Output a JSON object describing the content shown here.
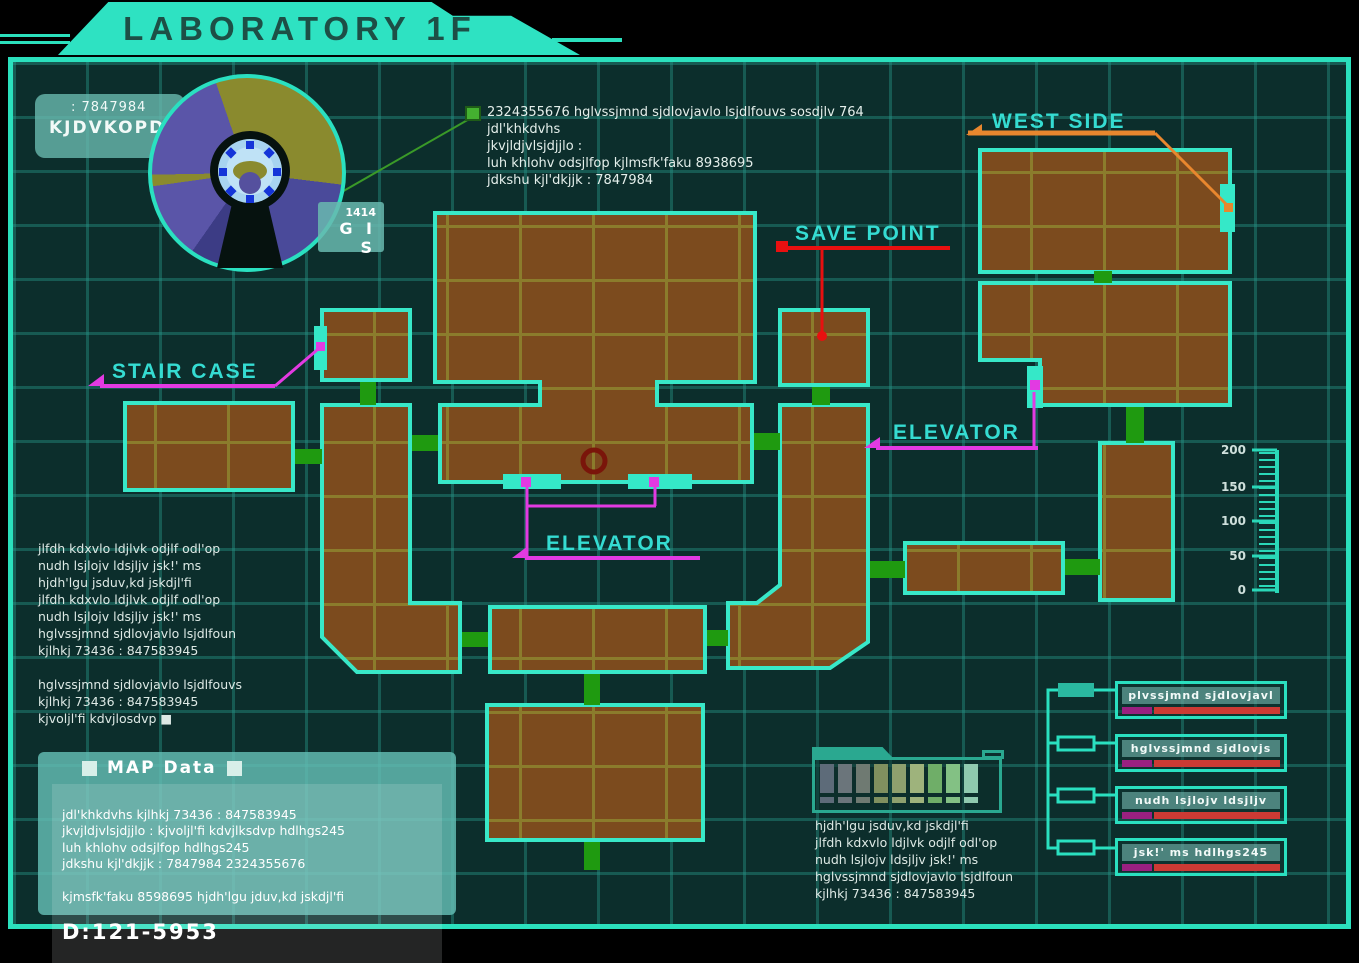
{
  "title": "LABORATORY 1F",
  "radar": {
    "code": ": 7847984",
    "name": "KJDVKOPDS",
    "badge_value": "1414",
    "badge_label": "G I S"
  },
  "k_block": {
    "heading": "K:2501-GIS",
    "lines": [
      "hjdh'lgu jduv,kd jskdjlfi",
      "jlfdh kdxvlo ldjlvk odjlf odl'op",
      "nudh lsjlolv ldsjllv 2sk!' ms",
      "",
      "makluku ims"
    ]
  },
  "annotation": {
    "lines": [
      "2324355676 hglvssjmnd sjdlovjavlo lsjdlfouvs sosdjlv 764",
      "jdl'khkdvhs",
      "jkvjldjvlsjdjjlo :",
      "luh khlohv odsjlfop kjlmsfk'faku 8938695",
      "jdkshu kjl'dkjjk : 7847984"
    ]
  },
  "map_labels": {
    "west_side": "WEST SIDE",
    "save_point": "SAVE POINT",
    "stair_case": "STAIR CASE",
    "elevator_center": "ELEVATOR",
    "elevator_east": "ELEVATOR"
  },
  "left_block": {
    "lines": [
      "jlfdh kdxvlo ldjlvk odjlf odl'op",
      "nudh lsjlojv ldsjljv jsk!' ms",
      "hjdh'lgu jsduv,kd jskdjl'fi",
      "jlfdh kdxvlo ldjlvk odjlf odl'op",
      "nudh lsjlojv ldsjljv jsk!' ms",
      "hglvssjmnd sjdlovjavlo lsjdlfoun",
      "kjlhkj 73436 : 847583945",
      "",
      "hglvssjmnd sjdlovjavlo lsjdlfouvs",
      "kjlhkj 73436 : 847583945",
      "kjvoljl'fi kdvjlosdvp ■"
    ]
  },
  "map_data_panel": {
    "heading": "MAP Data",
    "lines": [
      "jdl'khkdvhs kjlhkj 73436 : 847583945",
      "jkvjldjvlsjdjjlo :  kjvoljl'fi kdvjlksdvp hdlhgs245",
      "luh khlohv odsjlfop hdlhgs245",
      "jdkshu kjl'dkjjk : 7847984 2324355676",
      "",
      "kjmsfk'faku 8598695 hjdh'lgu jduv,kd jskdjl'fi"
    ],
    "id": "D:121-5953"
  },
  "scale": {
    "ticks": [
      "200",
      "150",
      "100",
      "50",
      "0"
    ]
  },
  "legend": {
    "items": [
      {
        "label": "plvssjmnd sjdlovjavl"
      },
      {
        "label": "hglvssjmnd sjdlovjs"
      },
      {
        "label": "nudh lsjlojv ldsjljv"
      },
      {
        "label": "jsk!' ms  hdlhgs245"
      }
    ],
    "bar_purple": "#9a2080",
    "bar_red": "#cc3a34"
  },
  "palette": {
    "swatches": [
      "#5d6b79",
      "#6b757b",
      "#6f7a72",
      "#80905f",
      "#8ea06e",
      "#9eb37c",
      "#6fae68",
      "#83c184",
      "#8fc9ae"
    ],
    "caption_lines": [
      "hjdh'lgu jsduv,kd jskdjl'fi",
      "jlfdh kdxvlo ldjlvk odjlf odl'op",
      "nudh lsjlojv ldsjljv jsk!' ms",
      "hglvssjmnd sjdlovjavlo lsjdlfoun",
      "kjlhkj 73436 : 847583945"
    ]
  },
  "colors": {
    "frame_teal": "#2be0bd",
    "room_brown": "#7c4b1e",
    "room_grid_olive": "#8b7c2c",
    "door_green": "#1f9a10",
    "label_cyan": "#35dcd2",
    "marker_magenta": "#e23ae2",
    "marker_red": "#e81010",
    "marker_orange": "#e8872e",
    "annotation_green": "#44b030",
    "panel_teal": "#5ab4aa"
  }
}
